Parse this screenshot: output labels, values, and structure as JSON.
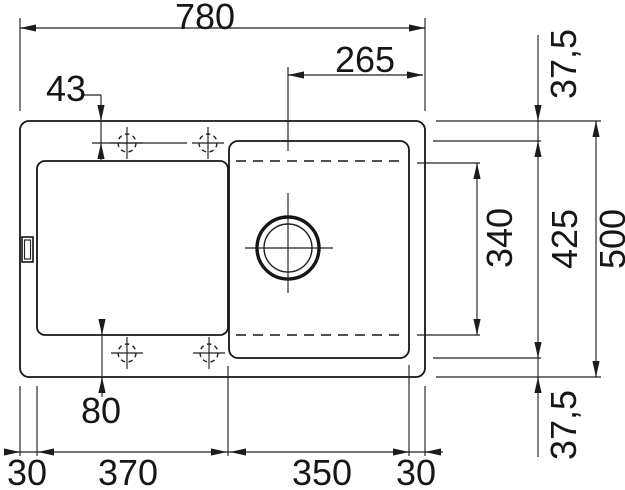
{
  "colors": {
    "line": "#222222",
    "object_line": "#161616",
    "background": "#ffffff"
  },
  "dimensions": {
    "overall_width": "780",
    "drain_to_right_edge": "265",
    "tap_offset_top": "43",
    "tap_offset_bottom": "80",
    "rim_top": "37,5",
    "bowl_inner_length": "340",
    "bowl_length": "425",
    "overall_depth": "500",
    "rim_bottom": "37,5",
    "rim_left": "30",
    "drainboard_width": "370",
    "bowl_width": "350",
    "rim_right": "30"
  }
}
